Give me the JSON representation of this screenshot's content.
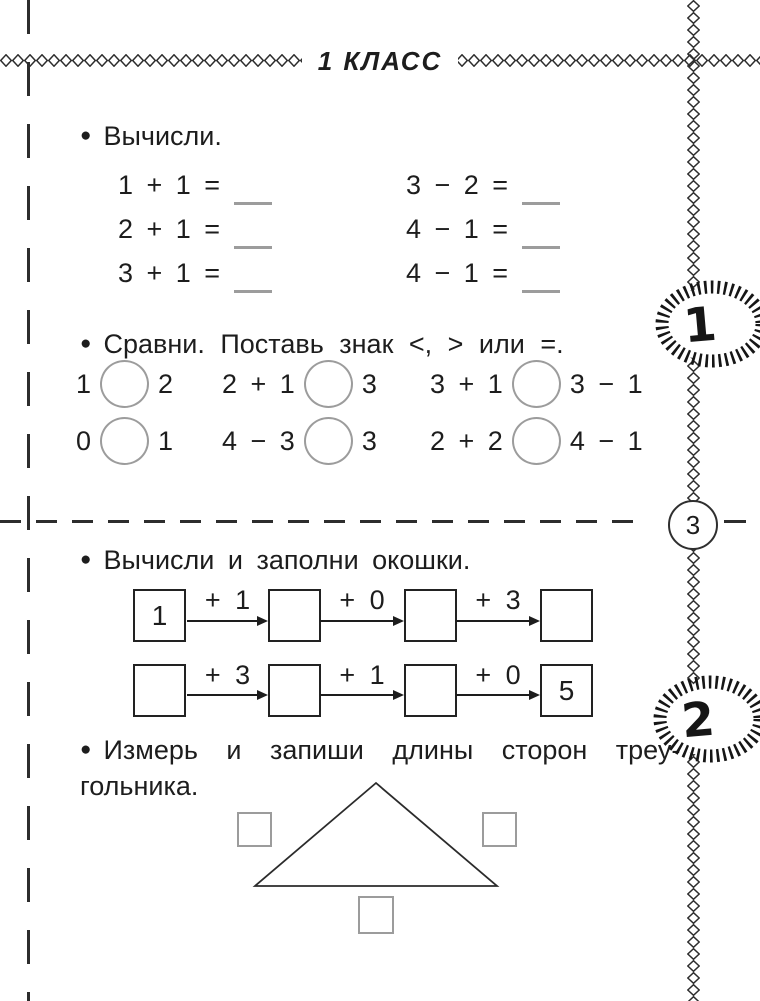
{
  "page": {
    "title": "1 КЛАСС",
    "page_number": "3",
    "bullet": "●",
    "stamp_badges": {
      "first": "1",
      "second": "2"
    },
    "colors": {
      "ink": "#1d1d1d",
      "answer_gray": "#9c9c9c"
    }
  },
  "task_calculate": {
    "title": "Вычисли.",
    "left_column": [
      "1 + 1 =",
      "2 + 1 =",
      "3 + 1 ="
    ],
    "right_column": [
      "3 − 2 =",
      "4 − 1 =",
      "4 − 1 ="
    ]
  },
  "task_compare": {
    "title": "Сравни. Поставь знак <, > или =.",
    "rows": [
      [
        {
          "left": "1",
          "right": "2"
        },
        {
          "left": "2 + 1",
          "right": "3"
        },
        {
          "left": "3 + 1",
          "right": "3 − 1"
        }
      ],
      [
        {
          "left": "0",
          "right": "1"
        },
        {
          "left": "4 − 3",
          "right": "3"
        },
        {
          "left": "2 + 2",
          "right": "4 − 1"
        }
      ]
    ]
  },
  "task_chains": {
    "title": "Вычисли и заполни окошки.",
    "rows": [
      {
        "boxes": [
          "1",
          "",
          "",
          ""
        ],
        "ops": [
          "+ 1",
          "+ 0",
          "+ 3"
        ]
      },
      {
        "boxes": [
          "",
          "",
          "",
          "5"
        ],
        "ops": [
          "+ 3",
          "+ 1",
          "+ 0"
        ]
      }
    ]
  },
  "task_triangle": {
    "title_line1": "Измерь и запиши длины сторон треу-",
    "title_line2": "гольника."
  }
}
